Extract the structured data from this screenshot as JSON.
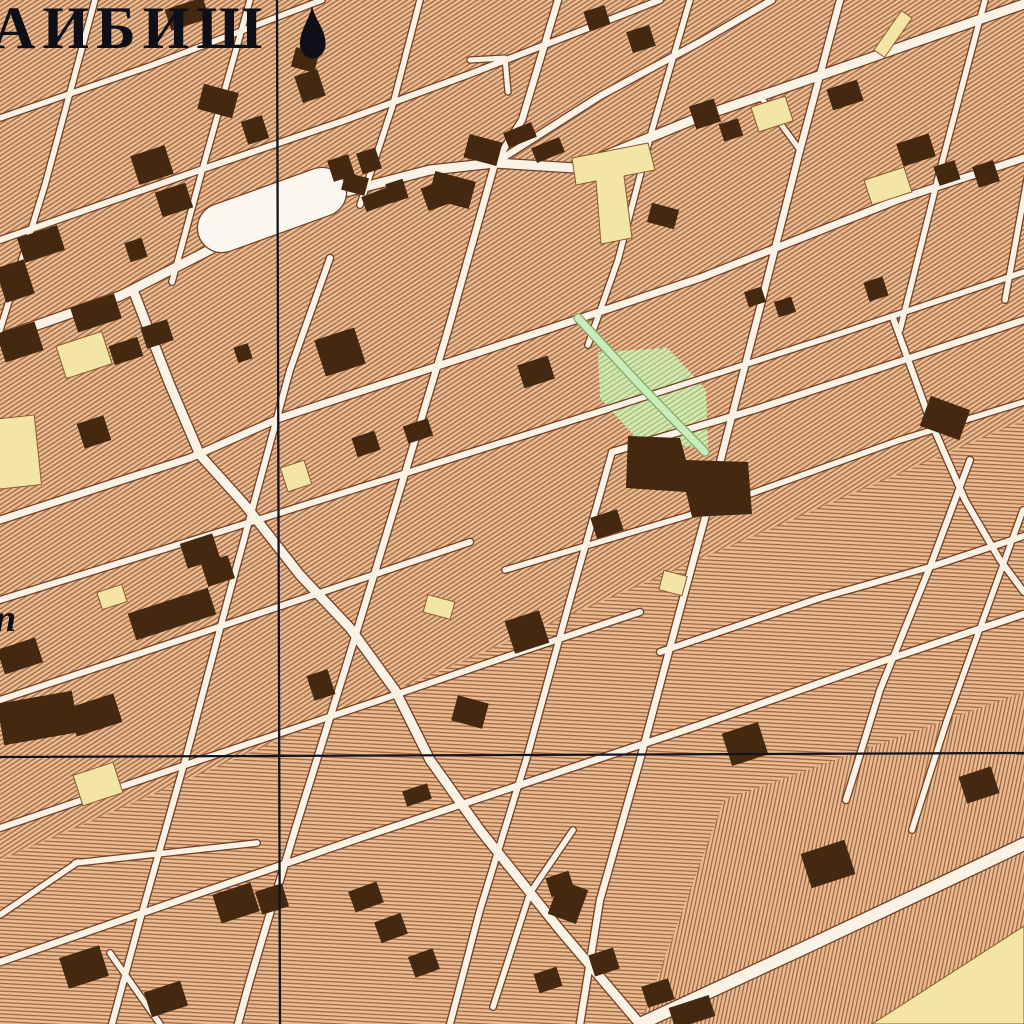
{
  "labels": {
    "city_name": "АИБИШ",
    "street_fragment": "п"
  },
  "symbols": {
    "landmark_symbol": "mosque-icon"
  },
  "colors": {
    "base": "#e9bb8f",
    "hatch": "#9a6142",
    "street_fill": "#f9f2e5",
    "casing": "#744026",
    "building": "#44280f",
    "landmark": "#f3e5a6",
    "landmark_edge": "#8a5a30",
    "green_fill": "#c9ecba",
    "green_edge": "#7da869",
    "green_base": "#dbe7b2",
    "green_hatch": "#96c178",
    "plaza": "#fcf7ee",
    "grid": "#13141f",
    "text": "#0f0f18"
  },
  "grid": {
    "vertical_x": 278,
    "horizontal_y": 755
  },
  "hatch_regions": [
    {
      "pattern": "hB",
      "pts": [
        [
          0,
          860
        ],
        [
          1024,
          420
        ],
        [
          1024,
          1024
        ],
        [
          0,
          1024
        ]
      ]
    },
    {
      "pattern": "hC",
      "pts": [
        [
          640,
          1024
        ],
        [
          724,
          800
        ],
        [
          1024,
          692
        ],
        [
          1024,
          1024
        ]
      ]
    }
  ],
  "plaza": {
    "x1": 222,
    "y1": 228,
    "x2": 322,
    "y2": 192,
    "w": 48
  },
  "streets": [
    {
      "k": "r",
      "w": 5.5,
      "pts": [
        [
          0,
          118
        ],
        [
          150,
          66
        ],
        [
          322,
          0
        ]
      ]
    },
    {
      "k": "r",
      "w": 6,
      "pts": [
        [
          0,
          240
        ],
        [
          200,
          170
        ],
        [
          340,
          122
        ],
        [
          470,
          74
        ],
        [
          660,
          0
        ]
      ]
    },
    {
      "k": "r",
      "w": 9,
      "pts": [
        [
          0,
          338
        ],
        [
          120,
          296
        ],
        [
          225,
          242
        ],
        [
          345,
          192
        ],
        [
          430,
          170
        ],
        [
          495,
          163
        ],
        [
          575,
          168
        ],
        [
          700,
          117
        ],
        [
          830,
          72
        ],
        [
          1024,
          4
        ]
      ]
    },
    {
      "k": "r",
      "w": 6.5,
      "pts": [
        [
          495,
          163
        ],
        [
          600,
          96
        ],
        [
          700,
          42
        ],
        [
          772,
          0
        ]
      ]
    },
    {
      "k": "r",
      "w": 7,
      "pts": [
        [
          0,
          520
        ],
        [
          190,
          458
        ],
        [
          280,
          418
        ],
        [
          480,
          352
        ],
        [
          700,
          278
        ],
        [
          900,
          199
        ],
        [
          1024,
          158
        ]
      ]
    },
    {
      "k": "r",
      "w": 5.5,
      "pts": [
        [
          430,
          465
        ],
        [
          620,
          405
        ],
        [
          830,
          337
        ],
        [
          1024,
          272
        ]
      ]
    },
    {
      "k": "r",
      "w": 6,
      "pts": [
        [
          0,
          600
        ],
        [
          200,
          538
        ],
        [
          400,
          475
        ],
        [
          608,
          409
        ]
      ]
    },
    {
      "k": "r",
      "w": 6.5,
      "pts": [
        [
          612,
          452
        ],
        [
          760,
          408
        ],
        [
          940,
          348
        ],
        [
          1024,
          320
        ]
      ]
    },
    {
      "k": "r",
      "w": 6,
      "pts": [
        [
          0,
          700
        ],
        [
          180,
          640
        ],
        [
          370,
          576
        ],
        [
          470,
          542
        ]
      ]
    },
    {
      "k": "r",
      "w": 5.5,
      "pts": [
        [
          505,
          570
        ],
        [
          700,
          512
        ],
        [
          900,
          440
        ],
        [
          1024,
          402
        ]
      ]
    },
    {
      "k": "r",
      "w": 6,
      "pts": [
        [
          0,
          828
        ],
        [
          200,
          760
        ],
        [
          380,
          700
        ],
        [
          520,
          652
        ],
        [
          640,
          612
        ]
      ]
    },
    {
      "k": "r",
      "w": 6,
      "pts": [
        [
          660,
          652
        ],
        [
          820,
          598
        ],
        [
          930,
          567
        ],
        [
          1024,
          536
        ]
      ]
    },
    {
      "k": "r",
      "w": 6.5,
      "pts": [
        [
          0,
          962
        ],
        [
          180,
          900
        ],
        [
          360,
          838
        ],
        [
          520,
          785
        ],
        [
          700,
          725
        ],
        [
          880,
          662
        ],
        [
          1024,
          614
        ]
      ]
    },
    {
      "k": "r",
      "w": 12,
      "pts": [
        [
          640,
          1024
        ],
        [
          800,
          950
        ],
        [
          940,
          884
        ],
        [
          1024,
          844
        ]
      ]
    },
    {
      "k": "r",
      "w": 5.5,
      "pts": [
        [
          75,
          863
        ],
        [
          257,
          843
        ]
      ]
    },
    {
      "k": "r",
      "w": 5.5,
      "pts": [
        [
          95,
          0
        ],
        [
          45,
          185
        ],
        [
          0,
          330
        ]
      ]
    },
    {
      "k": "r",
      "w": 5.5,
      "pts": [
        [
          250,
          0
        ],
        [
          205,
          160
        ],
        [
          172,
          282
        ]
      ]
    },
    {
      "k": "r",
      "w": 5.5,
      "pts": [
        [
          420,
          0
        ],
        [
          392,
          108
        ],
        [
          360,
          205
        ]
      ]
    },
    {
      "k": "r",
      "w": 6,
      "pts": [
        [
          330,
          258
        ],
        [
          290,
          370
        ],
        [
          233,
          580
        ],
        [
          186,
          757
        ],
        [
          140,
          920
        ],
        [
          112,
          1024
        ]
      ]
    },
    {
      "k": "r",
      "w": 6.5,
      "pts": [
        [
          558,
          0
        ],
        [
          522,
          120
        ],
        [
          495,
          163
        ],
        [
          448,
          330
        ],
        [
          400,
          490
        ],
        [
          348,
          660
        ],
        [
          295,
          830
        ],
        [
          250,
          980
        ],
        [
          238,
          1024
        ]
      ]
    },
    {
      "k": "r",
      "w": 5.5,
      "pts": [
        [
          690,
          0
        ],
        [
          652,
          130
        ],
        [
          618,
          260
        ],
        [
          588,
          345
        ]
      ]
    },
    {
      "k": "r",
      "w": 6,
      "pts": [
        [
          612,
          452
        ],
        [
          570,
          600
        ],
        [
          527,
          757
        ],
        [
          480,
          910
        ],
        [
          450,
          1024
        ]
      ]
    },
    {
      "k": "r",
      "w": 6.5,
      "pts": [
        [
          840,
          0
        ],
        [
          800,
          150
        ],
        [
          762,
          300
        ],
        [
          718,
          470
        ],
        [
          680,
          610
        ],
        [
          640,
          760
        ],
        [
          600,
          900
        ],
        [
          580,
          1024
        ]
      ]
    },
    {
      "k": "r",
      "w": 5.5,
      "pts": [
        [
          985,
          0
        ],
        [
          940,
          170
        ],
        [
          900,
          330
        ]
      ]
    },
    {
      "k": "r",
      "w": 6,
      "pts": [
        [
          970,
          460
        ],
        [
          930,
          567
        ],
        [
          880,
          690
        ],
        [
          846,
          800
        ]
      ]
    },
    {
      "k": "r",
      "w": 5.5,
      "pts": [
        [
          1060,
          0
        ],
        [
          1005,
          300
        ]
      ]
    },
    {
      "k": "r",
      "w": 5.5,
      "pts": [
        [
          1023,
          510
        ],
        [
          983,
          620
        ],
        [
          947,
          720
        ],
        [
          912,
          830
        ]
      ]
    },
    {
      "k": "r",
      "w": 9,
      "pts": [
        [
          135,
          295
        ],
        [
          170,
          385
        ],
        [
          200,
          455
        ],
        [
          245,
          505
        ],
        [
          300,
          575
        ],
        [
          350,
          628
        ],
        [
          395,
          690
        ],
        [
          430,
          760
        ],
        [
          480,
          830
        ],
        [
          560,
          930
        ],
        [
          640,
          1024
        ]
      ]
    },
    {
      "k": "r",
      "w": 6,
      "pts": [
        [
          893,
          318
        ],
        [
          930,
          420
        ],
        [
          965,
          500
        ],
        [
          1000,
          560
        ],
        [
          1024,
          592
        ]
      ]
    },
    {
      "k": "r",
      "w": 5.5,
      "pts": [
        [
          110,
          953
        ],
        [
          160,
          1024
        ]
      ]
    },
    {
      "k": "r",
      "w": 5.5,
      "pts": [
        [
          78,
          862
        ],
        [
          0,
          915
        ]
      ]
    },
    {
      "k": "r",
      "w": 5,
      "pts": [
        [
          470,
          60
        ],
        [
          505,
          58
        ],
        [
          508,
          92
        ]
      ]
    },
    {
      "k": "r",
      "w": 5,
      "pts": [
        [
          760,
          96
        ],
        [
          800,
          150
        ]
      ]
    },
    {
      "k": "r",
      "w": 5.5,
      "pts": [
        [
          573,
          830
        ],
        [
          530,
          893
        ],
        [
          493,
          1007
        ]
      ]
    },
    {
      "k": "g",
      "w": 7,
      "pts": [
        [
          578,
          318
        ],
        [
          640,
          385
        ],
        [
          705,
          452
        ]
      ]
    }
  ],
  "green_area": {
    "pts": [
      [
        598,
        352
      ],
      [
        668,
        348
      ],
      [
        706,
        390
      ],
      [
        708,
        448
      ],
      [
        640,
        442
      ],
      [
        600,
        398
      ]
    ]
  },
  "building_polys": [
    {
      "pts": [
        [
          628,
          436
        ],
        [
          680,
          438
        ],
        [
          686,
          460
        ],
        [
          748,
          462
        ],
        [
          752,
          514
        ],
        [
          692,
          517
        ],
        [
          686,
          492
        ],
        [
          626,
          488
        ]
      ]
    }
  ],
  "buildings": [
    [
      187,
      14,
      40,
      22,
      -18
    ],
    [
      310,
      86,
      24,
      28,
      -18
    ],
    [
      218,
      101,
      26,
      36,
      -75
    ],
    [
      255,
      130,
      22,
      24,
      -18
    ],
    [
      152,
      165,
      36,
      30,
      -18
    ],
    [
      174,
      200,
      32,
      26,
      -18
    ],
    [
      136,
      250,
      18,
      20,
      -18
    ],
    [
      41,
      244,
      42,
      26,
      -18
    ],
    [
      15,
      281,
      30,
      36,
      -18
    ],
    [
      96,
      313,
      46,
      26,
      -18
    ],
    [
      20,
      342,
      40,
      30,
      -18
    ],
    [
      341,
      168,
      22,
      22,
      -18
    ],
    [
      369,
      161,
      20,
      22,
      -18
    ],
    [
      397,
      191,
      18,
      20,
      -18
    ],
    [
      452,
      190,
      28,
      42,
      -75
    ],
    [
      483,
      150,
      24,
      34,
      -75
    ],
    [
      520,
      135,
      30,
      16,
      -22
    ],
    [
      548,
      150,
      30,
      16,
      -22
    ],
    [
      435,
      196,
      22,
      24,
      -20
    ],
    [
      379,
      199,
      32,
      16,
      -20
    ],
    [
      355,
      184,
      18,
      24,
      -75
    ],
    [
      126,
      351,
      30,
      20,
      -18
    ],
    [
      157,
      334,
      28,
      22,
      -18
    ],
    [
      340,
      352,
      42,
      38,
      -18
    ],
    [
      243,
      353,
      15,
      16,
      -18
    ],
    [
      94,
      432,
      28,
      26,
      -18
    ],
    [
      536,
      372,
      32,
      24,
      -18
    ],
    [
      418,
      431,
      26,
      18,
      -18
    ],
    [
      366,
      444,
      24,
      20,
      -18
    ],
    [
      470,
      712,
      26,
      32,
      -75
    ],
    [
      527,
      632,
      36,
      34,
      -18
    ],
    [
      172,
      614,
      84,
      28,
      -18
    ],
    [
      20,
      656,
      40,
      26,
      -18
    ],
    [
      95,
      715,
      48,
      30,
      -18
    ],
    [
      38,
      718,
      76,
      42,
      -10
    ],
    [
      218,
      571,
      28,
      24,
      -18
    ],
    [
      321,
      685,
      22,
      26,
      -18
    ],
    [
      236,
      903,
      40,
      30,
      -18
    ],
    [
      272,
      899,
      28,
      24,
      -18
    ],
    [
      417,
      795,
      26,
      16,
      -18
    ],
    [
      366,
      897,
      30,
      22,
      -20
    ],
    [
      391,
      928,
      28,
      22,
      -20
    ],
    [
      424,
      963,
      26,
      22,
      -20
    ],
    [
      84,
      967,
      42,
      32,
      -18
    ],
    [
      166,
      999,
      38,
      26,
      -18
    ],
    [
      597,
      18,
      22,
      20,
      -18
    ],
    [
      641,
      39,
      24,
      22,
      -18
    ],
    [
      705,
      114,
      26,
      24,
      -18
    ],
    [
      731,
      130,
      20,
      18,
      -18
    ],
    [
      845,
      95,
      32,
      22,
      -18
    ],
    [
      916,
      150,
      34,
      24,
      -18
    ],
    [
      947,
      173,
      22,
      20,
      -18
    ],
    [
      986,
      174,
      22,
      22,
      -18
    ],
    [
      663,
      216,
      20,
      28,
      -75
    ],
    [
      755,
      297,
      18,
      16,
      -18
    ],
    [
      785,
      307,
      18,
      16,
      -18
    ],
    [
      876,
      289,
      20,
      20,
      -18
    ],
    [
      945,
      418,
      32,
      42,
      -70
    ],
    [
      745,
      744,
      38,
      34,
      -18
    ],
    [
      979,
      785,
      34,
      28,
      -18
    ],
    [
      828,
      864,
      46,
      36,
      -18
    ],
    [
      568,
      902,
      36,
      30,
      -70
    ],
    [
      604,
      962,
      26,
      22,
      -18
    ],
    [
      658,
      993,
      28,
      22,
      -18
    ],
    [
      692,
      1012,
      42,
      22,
      -18
    ],
    [
      985,
      1000,
      78,
      38,
      -22
    ],
    [
      200,
      551,
      34,
      26,
      -18
    ],
    [
      560,
      884,
      24,
      20,
      -18
    ],
    [
      548,
      980,
      24,
      20,
      -18
    ],
    [
      607,
      524,
      28,
      22,
      -18
    ],
    [
      305,
      60,
      20,
      24,
      -75
    ]
  ],
  "landmarks": [
    [
      84,
      355,
      48,
      34,
      -18
    ],
    [
      17,
      452,
      42,
      70,
      -6
    ],
    [
      296,
      476,
      25,
      25,
      -18
    ],
    [
      772,
      114,
      36,
      26,
      -18
    ],
    [
      888,
      186,
      42,
      26,
      -18
    ],
    [
      893,
      34,
      48,
      13,
      -55
    ],
    [
      112,
      597,
      26,
      18,
      -18
    ],
    [
      98,
      784,
      42,
      32,
      -18
    ],
    [
      439,
      607,
      18,
      28,
      -75
    ],
    [
      673,
      583,
      20,
      24,
      -75
    ]
  ],
  "landmark_polys": [
    {
      "name": "t-shaped-landmark",
      "pts": [
        [
          572,
          158
        ],
        [
          648,
          143
        ],
        [
          655,
          170
        ],
        [
          624,
          176
        ],
        [
          632,
          238
        ],
        [
          601,
          244
        ],
        [
          596,
          181
        ],
        [
          576,
          185
        ]
      ]
    },
    {
      "name": "corner-road-block",
      "pts": [
        [
          872,
          1024
        ],
        [
          1024,
          926
        ],
        [
          1024,
          1024
        ]
      ]
    }
  ]
}
